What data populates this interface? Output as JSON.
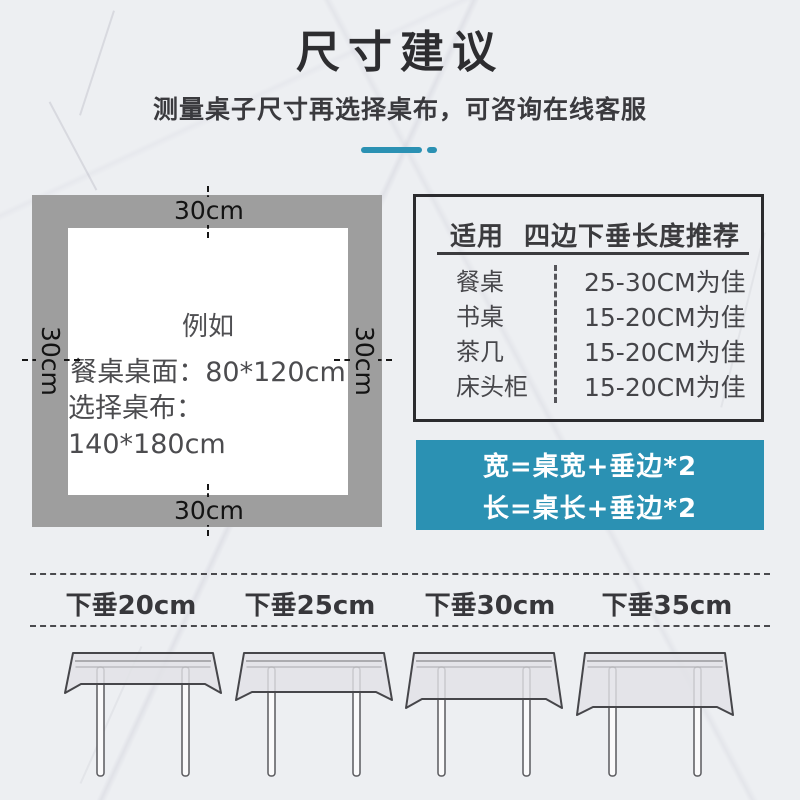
{
  "header": {
    "title": "尺寸建议",
    "subtitle": "测量桌子尺寸再选择桌布，可咨询在线客服"
  },
  "diagram": {
    "top_label": "30cm",
    "bottom_label": "30cm",
    "left_label": "30cm",
    "right_label": "30cm",
    "example_title": "例如",
    "example_line1": "餐桌桌面：80*120cm",
    "example_line2": "选择桌布：140*180cm"
  },
  "recommendation_table": {
    "header_col1": "适用",
    "header_col2": "四边下垂长度推荐",
    "rows": [
      {
        "use": "餐桌",
        "recommendation": "25-30CM为佳"
      },
      {
        "use": "书桌",
        "recommendation": "15-20CM为佳"
      },
      {
        "use": "茶几",
        "recommendation": "15-20CM为佳"
      },
      {
        "use": "床头柜",
        "recommendation": "15-20CM为佳"
      }
    ]
  },
  "formula_box": {
    "line1": "宽=桌宽+垂边*2",
    "line2": "长=桌长+垂边*2"
  },
  "drop_examples": {
    "labels": [
      "下垂20cm",
      "下垂25cm",
      "下垂30cm",
      "下垂35cm"
    ]
  },
  "colors": {
    "accent_teal": "#2B91B3",
    "diagram_gray": "#9E9E9E",
    "border_dark": "#2B2B2E",
    "text_dark": "#37373B"
  }
}
